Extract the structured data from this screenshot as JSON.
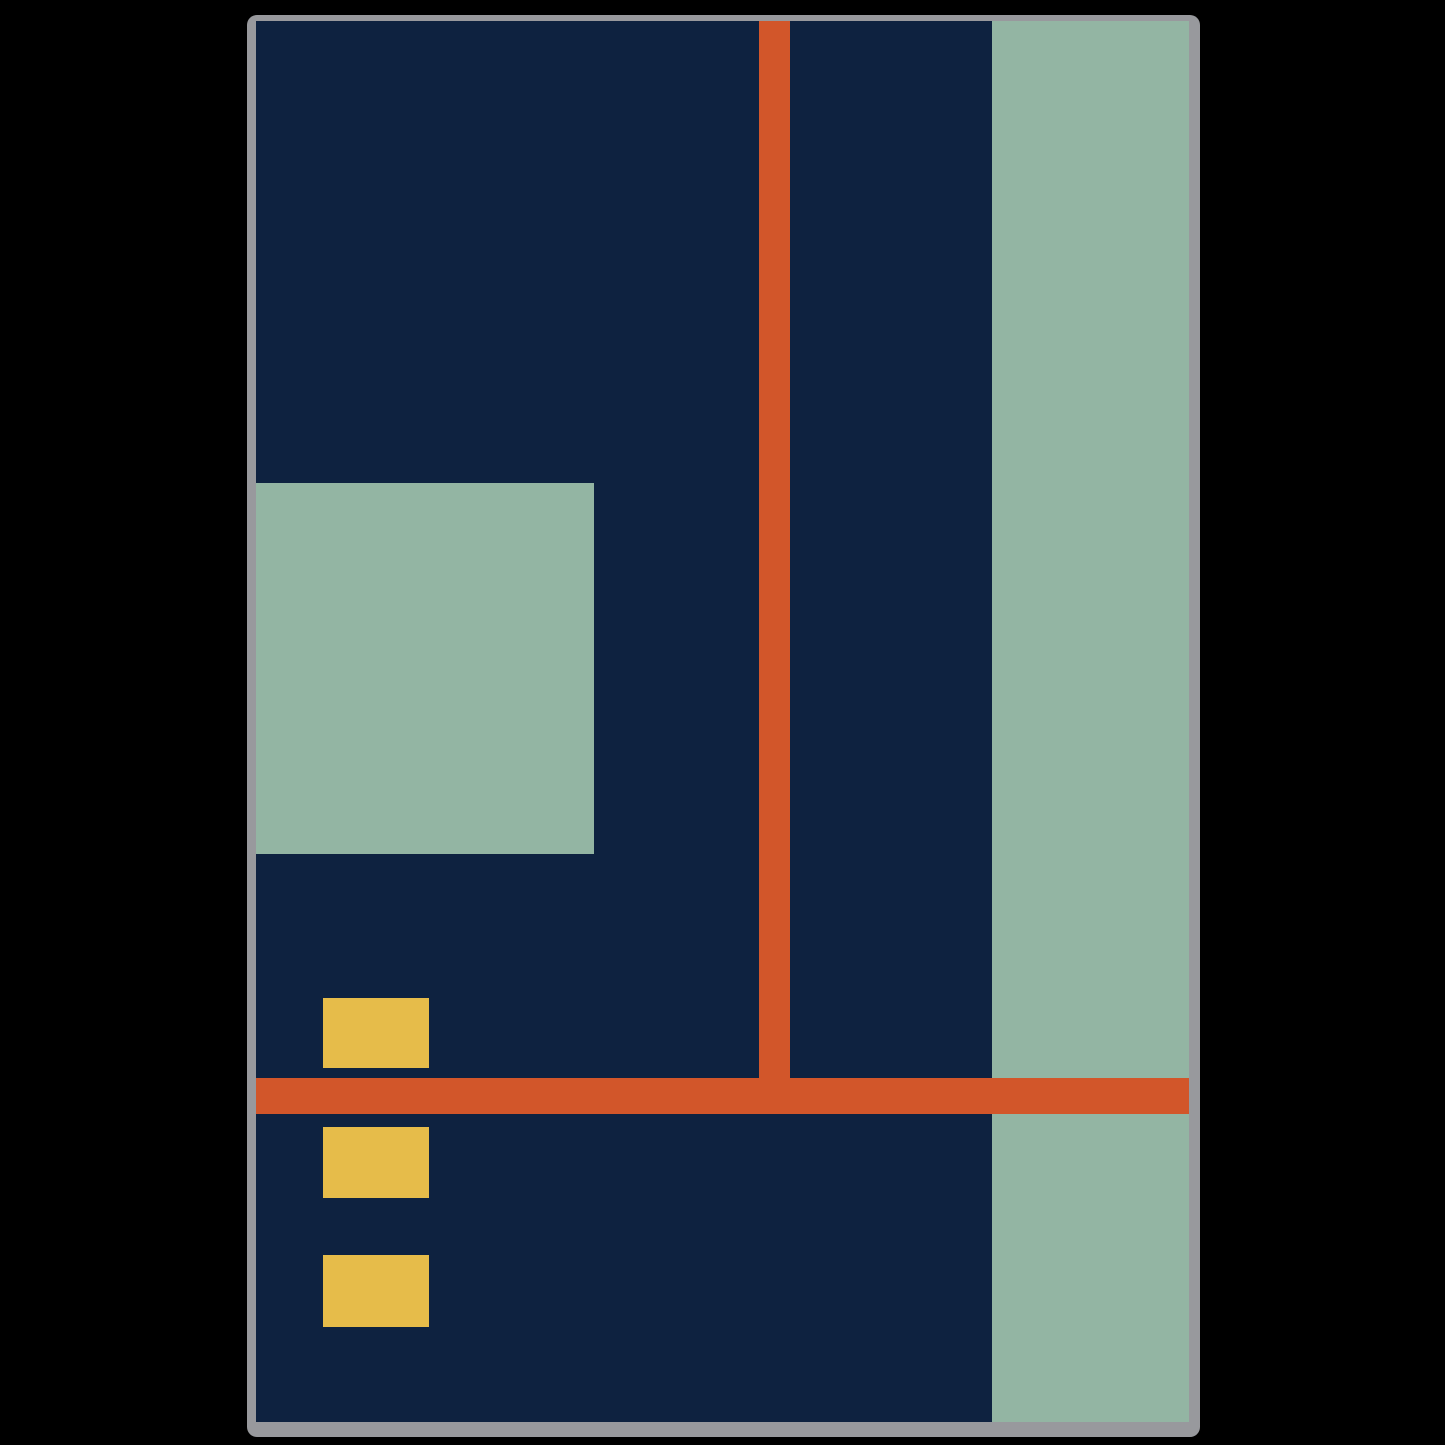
{
  "artwork": {
    "description": "abstract geometric art print mockup",
    "page_background": "#000000",
    "palette": {
      "navy": "#0e2240",
      "sage": "#93b5a3",
      "orange": "#d2562a",
      "gold": "#e6bc4a",
      "frame_gray": "#98999d"
    },
    "frame": {
      "color_key": "frame_gray"
    },
    "canvas": {
      "color_key": "navy"
    },
    "shapes": [
      {
        "name": "left-sage-square",
        "x": 0,
        "y": 462,
        "w": 338,
        "h": 371,
        "color": "sage"
      },
      {
        "name": "right-sage-stripe",
        "x": 736,
        "y": 0,
        "w": 197,
        "h": 1401,
        "color": "sage"
      },
      {
        "name": "vertical-orange-line",
        "x": 503,
        "y": 0,
        "w": 31,
        "h": 1057,
        "color": "orange"
      },
      {
        "name": "horizontal-orange-line",
        "x": 0,
        "y": 1057,
        "w": 933,
        "h": 36,
        "color": "orange"
      },
      {
        "name": "gold-square-top",
        "x": 67,
        "y": 977,
        "w": 106,
        "h": 70,
        "color": "gold"
      },
      {
        "name": "gold-square-middle",
        "x": 67,
        "y": 1106,
        "w": 106,
        "h": 71,
        "color": "gold"
      },
      {
        "name": "gold-square-bottom",
        "x": 67,
        "y": 1234,
        "w": 106,
        "h": 72,
        "color": "gold"
      }
    ]
  }
}
